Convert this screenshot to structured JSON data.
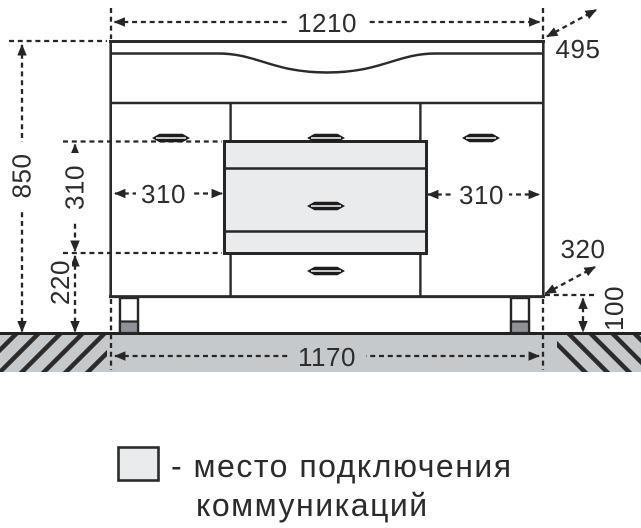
{
  "dims": {
    "top_width": "1210",
    "depth": "495",
    "total_height": "850",
    "comm_area_height": "310",
    "comm_area_floor_offset": "220",
    "left_door_width": "310",
    "right_door_width": "310",
    "comm_depth": "320",
    "leg_height": "100",
    "base_width": "1170"
  },
  "legend": {
    "text_line1": "- место подключения",
    "text_line2": "коммуникаций"
  },
  "colors": {
    "line": "#2b2b2b",
    "floor": "#c6c9cb",
    "comm_area_fill": "#e9ebec",
    "leg_foot": "#8e9296"
  }
}
